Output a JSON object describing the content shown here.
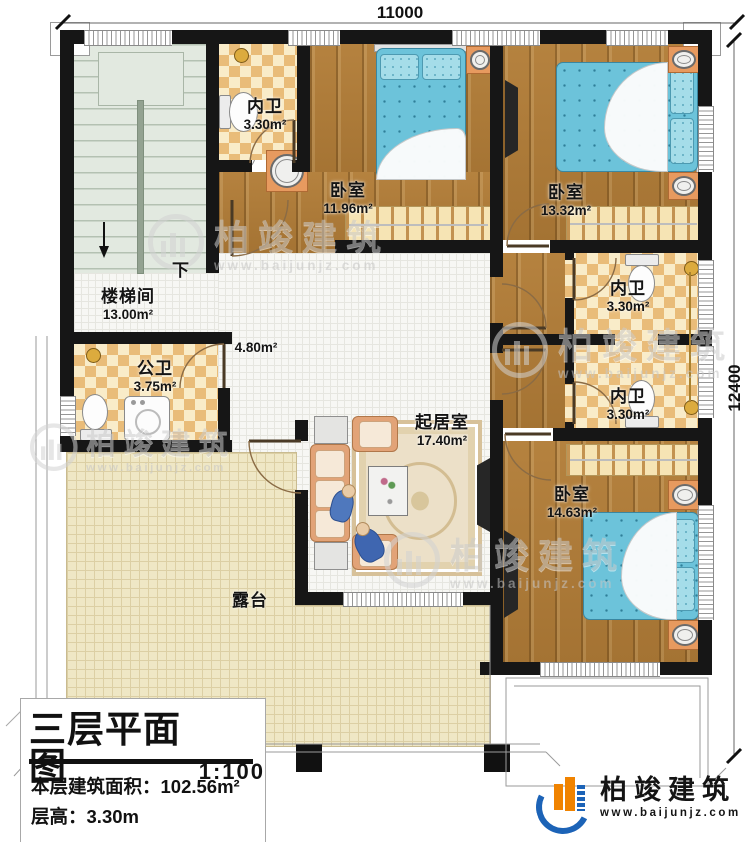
{
  "dimensions": {
    "top": "11000",
    "right": "12400"
  },
  "rooms": {
    "stairwell": {
      "name": "楼梯间",
      "area": "13.00m²",
      "down_label": "下"
    },
    "bath_top": {
      "name": "内卫",
      "area": "3.30m²"
    },
    "bedroom1": {
      "name": "卧室",
      "area": "11.96m²"
    },
    "bedroom2": {
      "name": "卧室",
      "area": "13.32m²"
    },
    "bath_mid1": {
      "name": "内卫",
      "area": "3.30m²"
    },
    "bath_mid2": {
      "name": "内卫",
      "area": "3.30m²"
    },
    "bedroom3": {
      "name": "卧室",
      "area": "14.63m²"
    },
    "living": {
      "name": "起居室",
      "area": "17.40m²"
    },
    "public_bath": {
      "name": "公卫",
      "area": "3.75m²"
    },
    "hall": {
      "area": "4.80m²"
    },
    "terrace": {
      "name": "露台"
    }
  },
  "title_block": {
    "title": "三层平面图",
    "scale": "1:100",
    "area_label": "本层建筑面积：",
    "area_value": "102.56m²",
    "floor_height_label": "层高：",
    "floor_height_value": "3.30m"
  },
  "brand": {
    "name": "柏竣建筑",
    "website": "www.baijunjz.com"
  },
  "watermark": {
    "name": "柏竣建筑",
    "website": "www.baijunjz.com"
  },
  "colors": {
    "wall": "#161616",
    "wood": "#ad7b39",
    "bed": "#6cc3da",
    "brand_blue": "#1c63b7",
    "brand_orange": "#f08300"
  }
}
